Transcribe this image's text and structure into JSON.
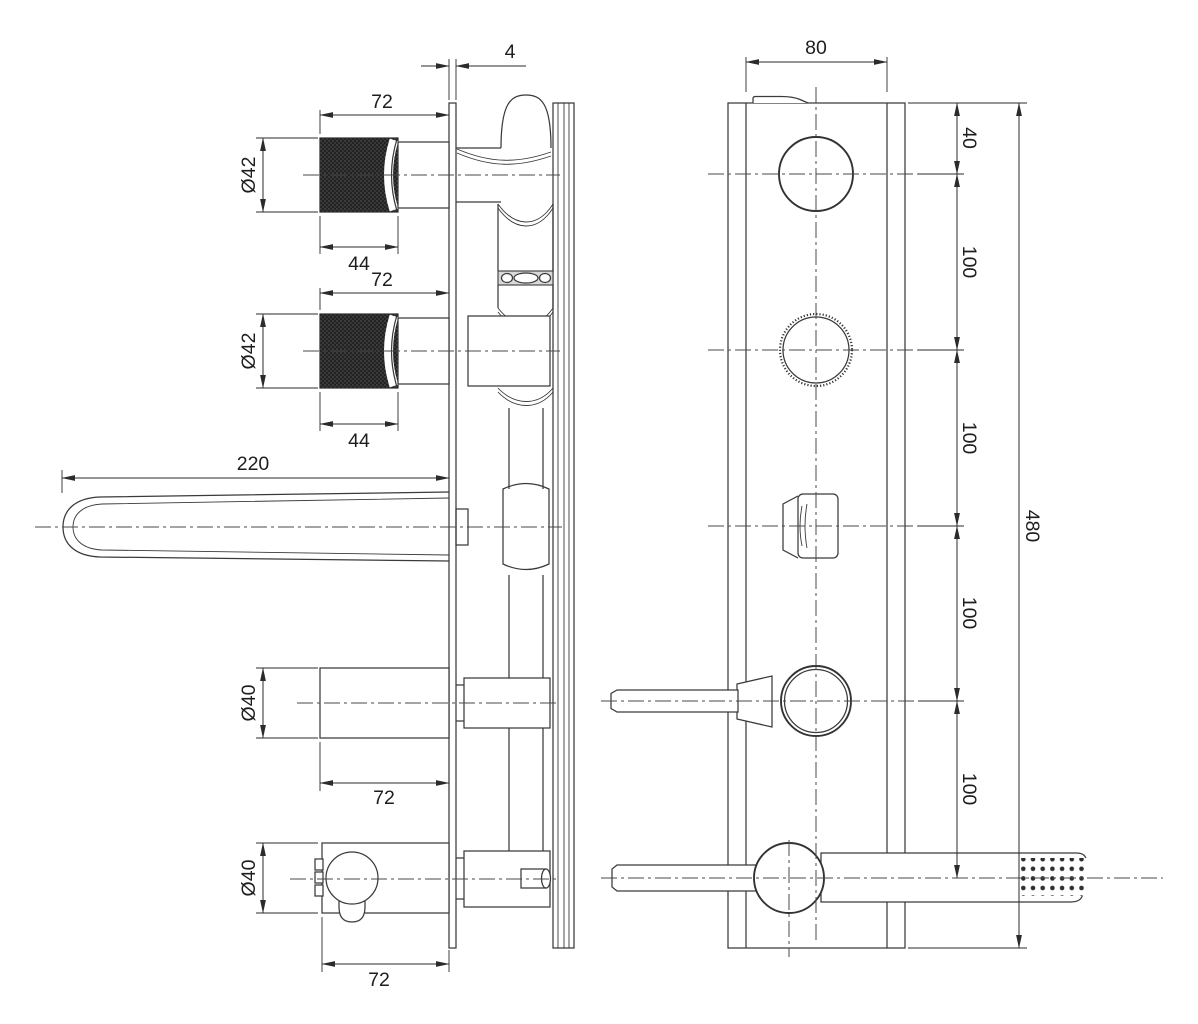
{
  "drawing": {
    "type": "technical-dimension-drawing",
    "subject": "wall-mounted-mixer-with-handshower",
    "colors": {
      "background": "#ffffff",
      "line": "#3a3a3a",
      "dimension": "#2b2b2b",
      "text": "#1e1e1e",
      "knurl_dark": "#222222",
      "slot_band_fill": "#d9d9d9"
    }
  },
  "dims": {
    "side": {
      "plate_thickness": "4",
      "knob_top_length": "72",
      "knob_top_diameter": "Ø42",
      "knob_top_grip_length": "44",
      "knob_bottom_length": "72",
      "knob_bottom_diameter": "Ø42",
      "knob_bottom_grip_length": "44",
      "spout_length": "220",
      "outlet_diameter": "Ø40",
      "outlet_length": "72",
      "bracket_diameter": "Ø40",
      "bracket_length": "72"
    },
    "front": {
      "plate_width": "80",
      "top_to_axis1": "40",
      "axis1_to_axis2": "100",
      "axis2_to_axis3": "100",
      "axis3_to_axis4": "100",
      "axis4_to_axis5": "100",
      "plate_height": "480"
    }
  }
}
